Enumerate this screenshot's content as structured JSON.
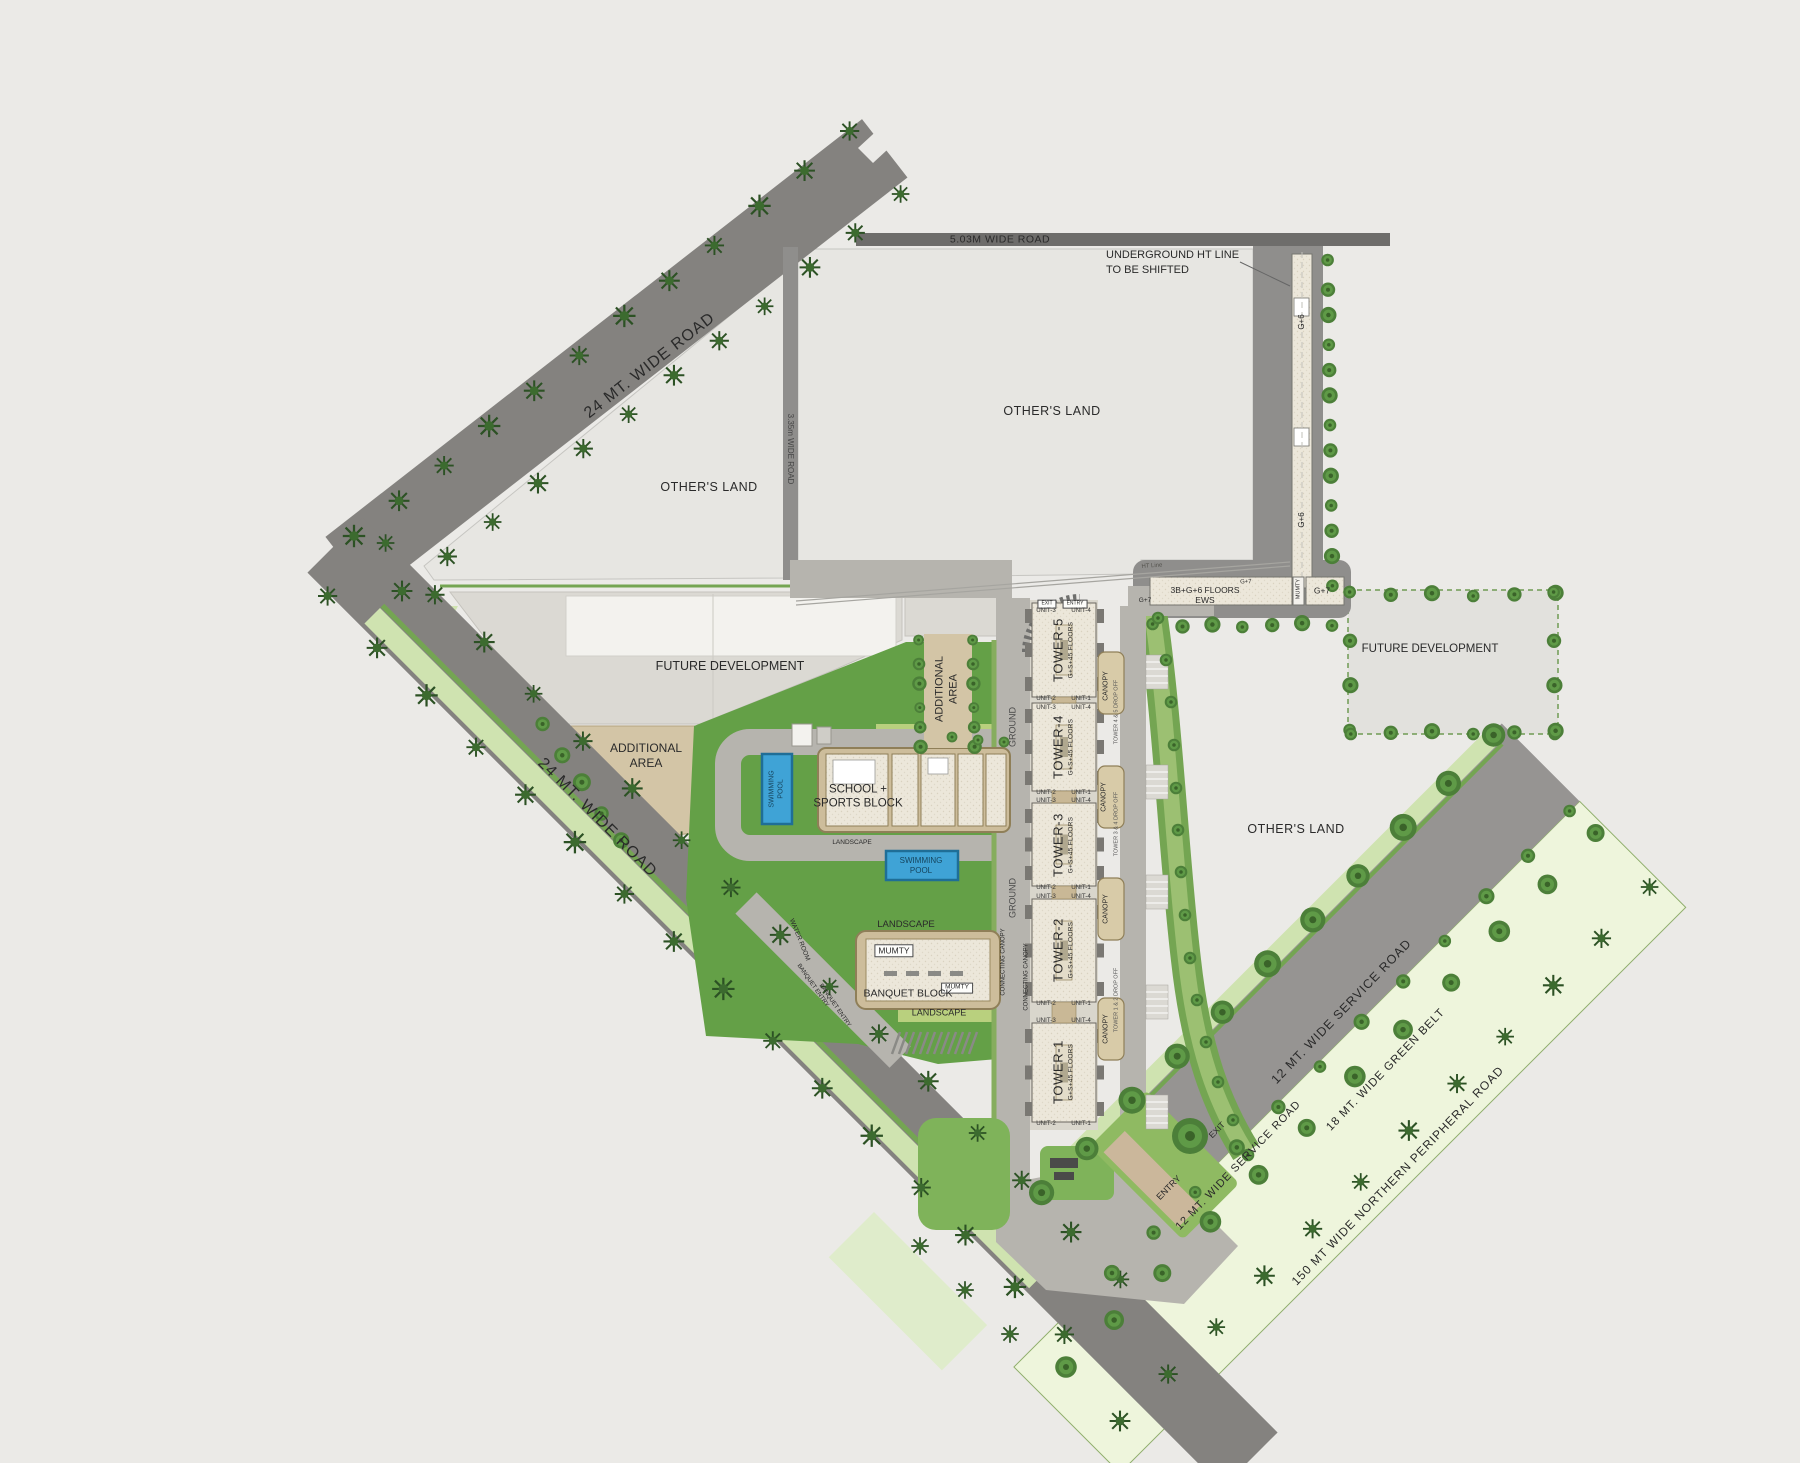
{
  "roads": {
    "wide_24_upper": "24 MT. WIDE ROAD",
    "wide_24_lower": "24 MT. WIDE ROAD",
    "wide_503": "5.03M WIDE ROAD",
    "wide_335": "3.35m WIDE ROAD",
    "service_upper": "12 MT. WIDE SERVICE ROAD",
    "service_lower": "12 MT. WIDE SERVICE ROAD",
    "green_belt": "18 MT. WIDE GREEN BELT",
    "peripheral": "150 MT WIDE NORTHERN PERIPHERAL ROAD"
  },
  "parcels": {
    "others_land_top": "OTHER'S LAND",
    "others_land_left": "OTHER'S LAND",
    "others_land_right": "OTHER'S LAND",
    "future_dev_left": "FUTURE DEVELOPMENT",
    "future_dev_right": "FUTURE DEVELOPMENT",
    "additional_area_left": "ADDITIONAL\nAREA",
    "additional_area_mid": "ADDITIONAL\nAREA"
  },
  "annotations": {
    "underground_ht": "UNDERGROUND HT LINE\nTO BE SHIFTED",
    "ht_line": "HT Line",
    "ews_block": "3B+G+6 FLOORS\nEWS",
    "g7_box": "G+7",
    "g7_small": "G+7",
    "g7_left": "G+7",
    "g6_upper": "G+6",
    "g6_lower": "G+6"
  },
  "towers": [
    {
      "name": "TOWER-5",
      "floors": "G+S+45 FLOORS"
    },
    {
      "name": "TOWER-4",
      "floors": "G+S+45 FLOORS"
    },
    {
      "name": "TOWER-3",
      "floors": "G+S+45 FLOORS"
    },
    {
      "name": "TOWER-2",
      "floors": "G+S+45 FLOORS"
    },
    {
      "name": "TOWER-1",
      "floors": "G+S+45 FLOORS"
    }
  ],
  "unit_labels": {
    "u1": "UNIT-1",
    "u2": "UNIT-2",
    "u3": "UNIT-3",
    "u4": "UNIT-4"
  },
  "amenities": {
    "school": "SCHOOL +\nSPORTS BLOCK",
    "banquet": "BANQUET BLOCK",
    "mumty": "MUMTY",
    "swimming_pool_v": "SWIMMING\nPOOL",
    "swimming_pool_h": "SWIMMING\nPOOL",
    "landscape": "LANDSCAPE",
    "water_room": "WATER ROOM",
    "banquet_entry": "BANQUET ENTRY"
  },
  "circulation": {
    "ground": "GROUND",
    "canopy": "CANOPY",
    "connecting_canopy": "CONNECTING CANOPY",
    "dropoff_45": "TOWER 4 & 5 DROP OFF",
    "dropoff_34": "TOWER 3 & 4 DROP OFF",
    "dropoff_12": "TOWER 1 & 2 DROP OFF",
    "entry": "ENTRY",
    "exit": "EXIT"
  },
  "colors": {
    "lawn_green": "#64a047",
    "light_green": "#cfe3b0",
    "belt_green": "#eef5dc",
    "road_gray": "#84827f",
    "internal_road_gray": "#b6b4ae",
    "compound_tan": "#cdbd9b",
    "pool_blue": "#3fa3d6",
    "building_cream": "#ece7da",
    "tree_green": "#4c7f39"
  }
}
